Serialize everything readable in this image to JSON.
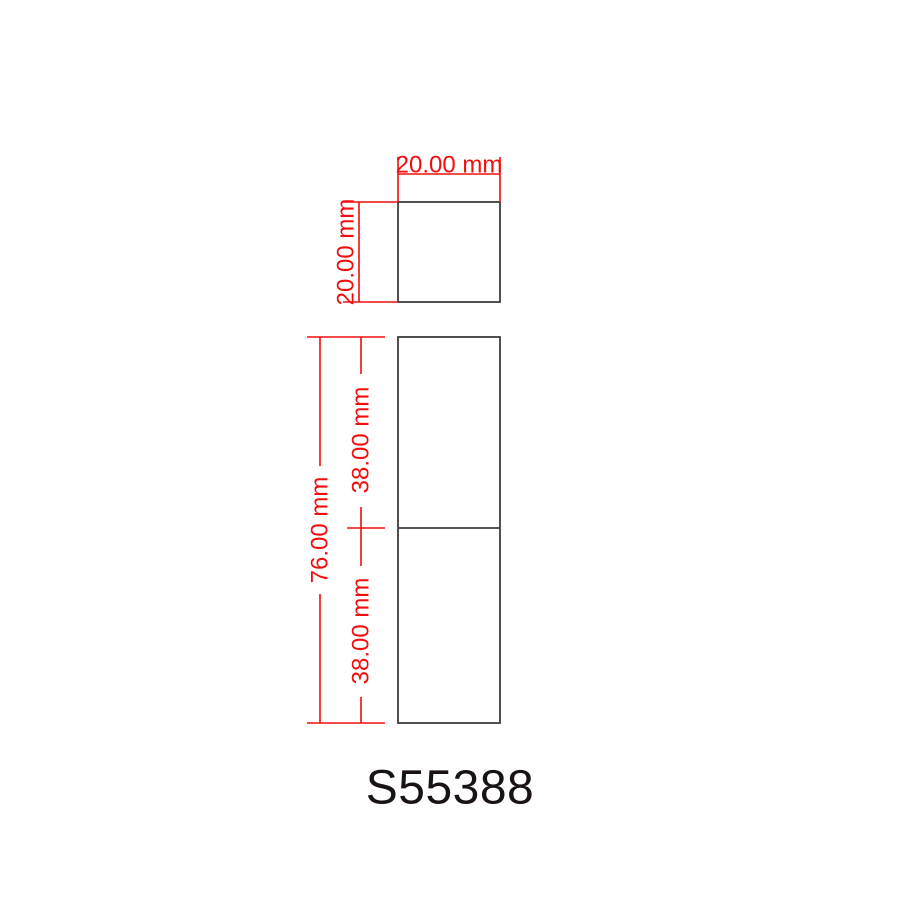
{
  "drawing": {
    "part_number": "S55388",
    "colors": {
      "dimension_red": "#f10e0e",
      "outline_gray": "#3e3e3e",
      "label_black": "#1a1313"
    },
    "top_view": {
      "width_mm": 20.0,
      "height_mm": 20.0,
      "width_label": "20.00 mm",
      "height_label": "20.00 mm"
    },
    "side_view": {
      "total_height_mm": 76.0,
      "upper_section_mm": 38.0,
      "lower_section_mm": 38.0,
      "total_height_label": "76.00 mm",
      "upper_section_label": "38.00 mm",
      "lower_section_label": "38.00 mm"
    }
  }
}
